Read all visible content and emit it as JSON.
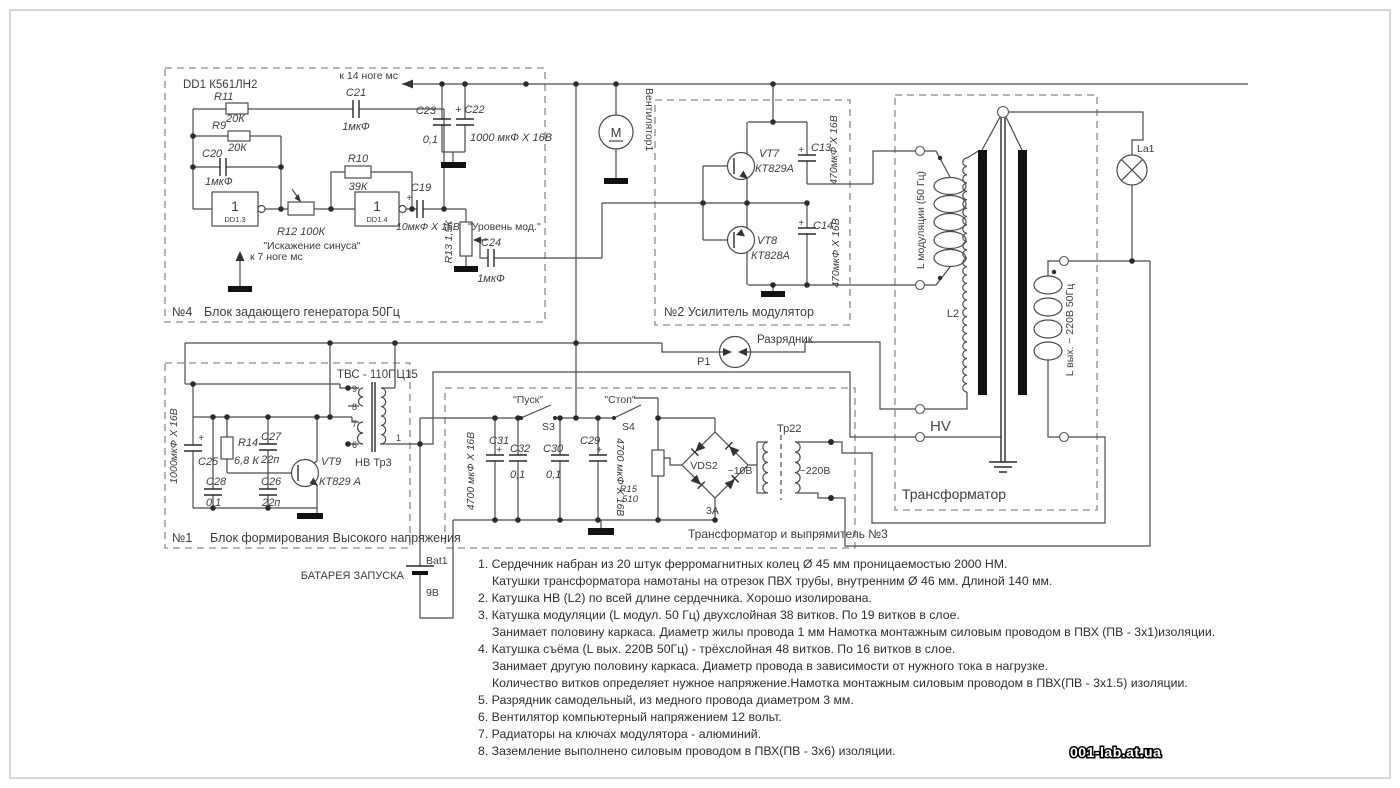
{
  "page": {
    "watermark": "001-lab.at.ua"
  },
  "b4": {
    "num": "№4",
    "title": "Блок задающего генератора 50Гц",
    "dd1": "DD1 К561ЛН2",
    "pin14": "к 14 ноге мс",
    "pin7": "к 7 ноге мс",
    "r11": "R11",
    "r11v": "20К",
    "r9": "R9",
    "r9v": "20К",
    "c20": "C20",
    "c20v": "1мкФ",
    "c21": "C21",
    "c21v": "1мкФ",
    "c23": "C23",
    "c23v": "0,1",
    "c22": "+ C22",
    "c22v": "1000 мкФ X 16В",
    "r10": "R10",
    "r10v": "39К",
    "g1": "1",
    "g1n": "DD1.3",
    "g2": "1",
    "g2n": "DD1.4",
    "r12": "R12  100К",
    "sine": "\"Искажение синуса\"",
    "c19": "C19",
    "c19v": "10мкФ X 16В",
    "plus": "+",
    "level": "\"Уровень мод.\"",
    "r13": "R13 1,5К",
    "c24": "C24",
    "c24v": "1мкФ"
  },
  "fan": {
    "label": "Вентилятор1",
    "m": "M"
  },
  "b2": {
    "title": "№2  Усилитель модулятор",
    "vt7": "VT7",
    "vt7t": "КТ829А",
    "vt8": "VT8",
    "vt8t": "КТ828А",
    "c13": "C13",
    "c13v": "470мкФ X 16В",
    "c14": "C14",
    "c14v": "470мкФ X 16В",
    "plus": "+"
  },
  "gap": {
    "label": "Разрядник",
    "ref": "P1"
  },
  "tr": {
    "title": "Трансформатор",
    "lmod": "L модуляции (50 Гц)",
    "l2": "L2",
    "lout": "L вых. ~ 220В 50Гц",
    "hv": "HV",
    "la1": "La1"
  },
  "b1": {
    "num": "№1",
    "title": "Блок формирования Высокого напряжения",
    "tvs": "ТВС - 110ПЦ15",
    "c25": "C25",
    "c25v": "1000мкФ X 16В",
    "plus": "+",
    "r14": "R14",
    "r14v": "6,8 К",
    "c27": "C27",
    "c27v": "22п",
    "c28": "C28",
    "c28v": "0,1",
    "c26": "C26",
    "c26v": "22п",
    "vt9": "VT9",
    "vt9t": "КТ829 А",
    "tr3": "НВ Тр3",
    "p9": "9",
    "p8": "8",
    "p7": "7",
    "p6": "6",
    "p1": "1"
  },
  "b3": {
    "title": "Трансформатор и выпрямитель  №3",
    "start": "\"Пуск\"",
    "s3": "S3",
    "stop": "\"Стоп\"",
    "s4": "S4",
    "c31": "C31",
    "c31v": "4700 мкФ X 16В",
    "c32": "C32",
    "c32v": "0,1",
    "c30": "C30",
    "c30v": "0,1",
    "c29": "C29",
    "c29v": "4700 мкФ X 16В",
    "plus": "+",
    "r15": "R15",
    "r15v": "510",
    "vds2": "VDS2",
    "amp": "3А",
    "tr22": "Тр22",
    "v10": "~10В",
    "v220": "~220В"
  },
  "bat": {
    "caption": "БАТАРЕЯ ЗАПУСКА",
    "ref": "Bat1",
    "v": "9В"
  },
  "notes": [
    {
      "t": "1.  Сердечник набран из 20 штук ферромагнитных колец Ø 45 мм проницаемостью 2000 НМ."
    },
    {
      "t": "Катушки трансформатора намотаны на отрезок ПВХ трубы, внутренним Ø 46 мм. Длиной 140 мм."
    },
    {
      "t": "2.  Катушка НВ (L2) по всей длине сердечника. Хорошо изолирована."
    },
    {
      "t": "3.  Катушка модуляции (L модул. 50 Гц) двухслойная 38 витков. По 19 витков в слое."
    },
    {
      "t": "Занимает половину каркаса.  Диаметр жилы провода 1 мм Намотка монтажным силовым проводом в ПВХ (ПВ - 3х1)изоляции."
    },
    {
      "t": "4.  Катушка съёма (L вых. 220В 50Гц) - трёхслойная 48 витков. По 16 витков в слое."
    },
    {
      "t": "Занимает другую половину каркаса. Диаметр провода в зависимости от нужного тока в нагрузке."
    },
    {
      "t": "Количество витков определяет нужное напряжение.Намотка монтажным силовым проводом в ПВХ(ПВ - 3х1.5) изоляции."
    },
    {
      "t": "5.  Разрядник самодельный, из медного провода диаметром 3 мм."
    },
    {
      "t": "6.  Вентилятор компьютерный напряжением 12 вольт."
    },
    {
      "t": "7.  Радиаторы на ключах модулятора - алюминий."
    },
    {
      "t": "8.  Заземление выполнено силовым проводом в ПВХ(ПВ - 3х6) изоляции."
    }
  ]
}
